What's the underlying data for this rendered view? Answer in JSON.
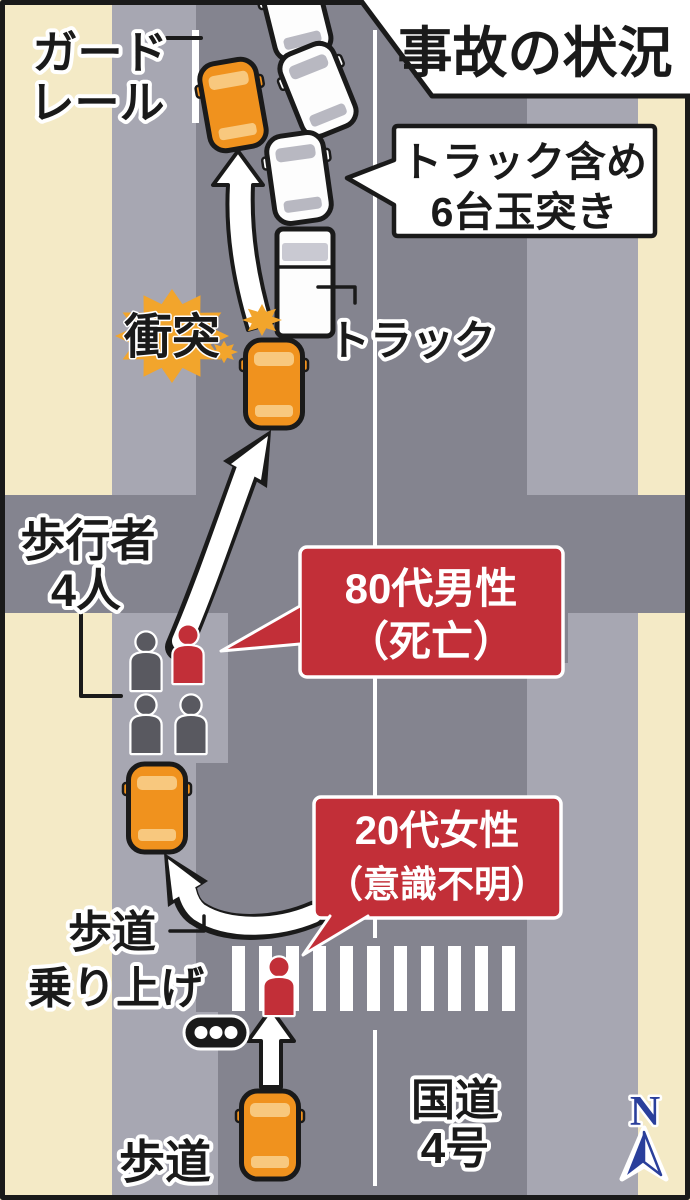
{
  "title": "事故の状況",
  "balloon": {
    "line1": "トラック含め",
    "line2": "6台玉突き"
  },
  "labels": {
    "guardrail": {
      "line1": "ガード",
      "line2": "レール"
    },
    "collision": "衝突",
    "truck": "トラック",
    "pedestrians": {
      "line1": "歩行者",
      "line2": "4人"
    },
    "sidewalk_mount": {
      "line1": "歩道",
      "line2": "乗り上げ"
    },
    "sidewalk_bottom": "歩道",
    "route": {
      "line1": "国道",
      "line2": "4号"
    },
    "compass": "N"
  },
  "callouts": {
    "male": {
      "line1": "80代男性",
      "line2": "（死亡）"
    },
    "female": {
      "line1": "20代女性",
      "line2": "（意識不明）"
    }
  },
  "colors": {
    "ground": "#f4eac6",
    "strip": "#a7a7b2",
    "road": "#84848f",
    "car_orange": "#f0921e",
    "car_orange_window": "#f8c87e",
    "car_white": "#fdfdfd",
    "car_white_window": "#b8b8c1",
    "truck_window": "#c9c9d2",
    "accent_red": "#c22f38",
    "burst": "#f2a52c",
    "ped_gray": "#595960",
    "compass_blue": "#2a3f9b",
    "ink": "#1a1a1a"
  }
}
